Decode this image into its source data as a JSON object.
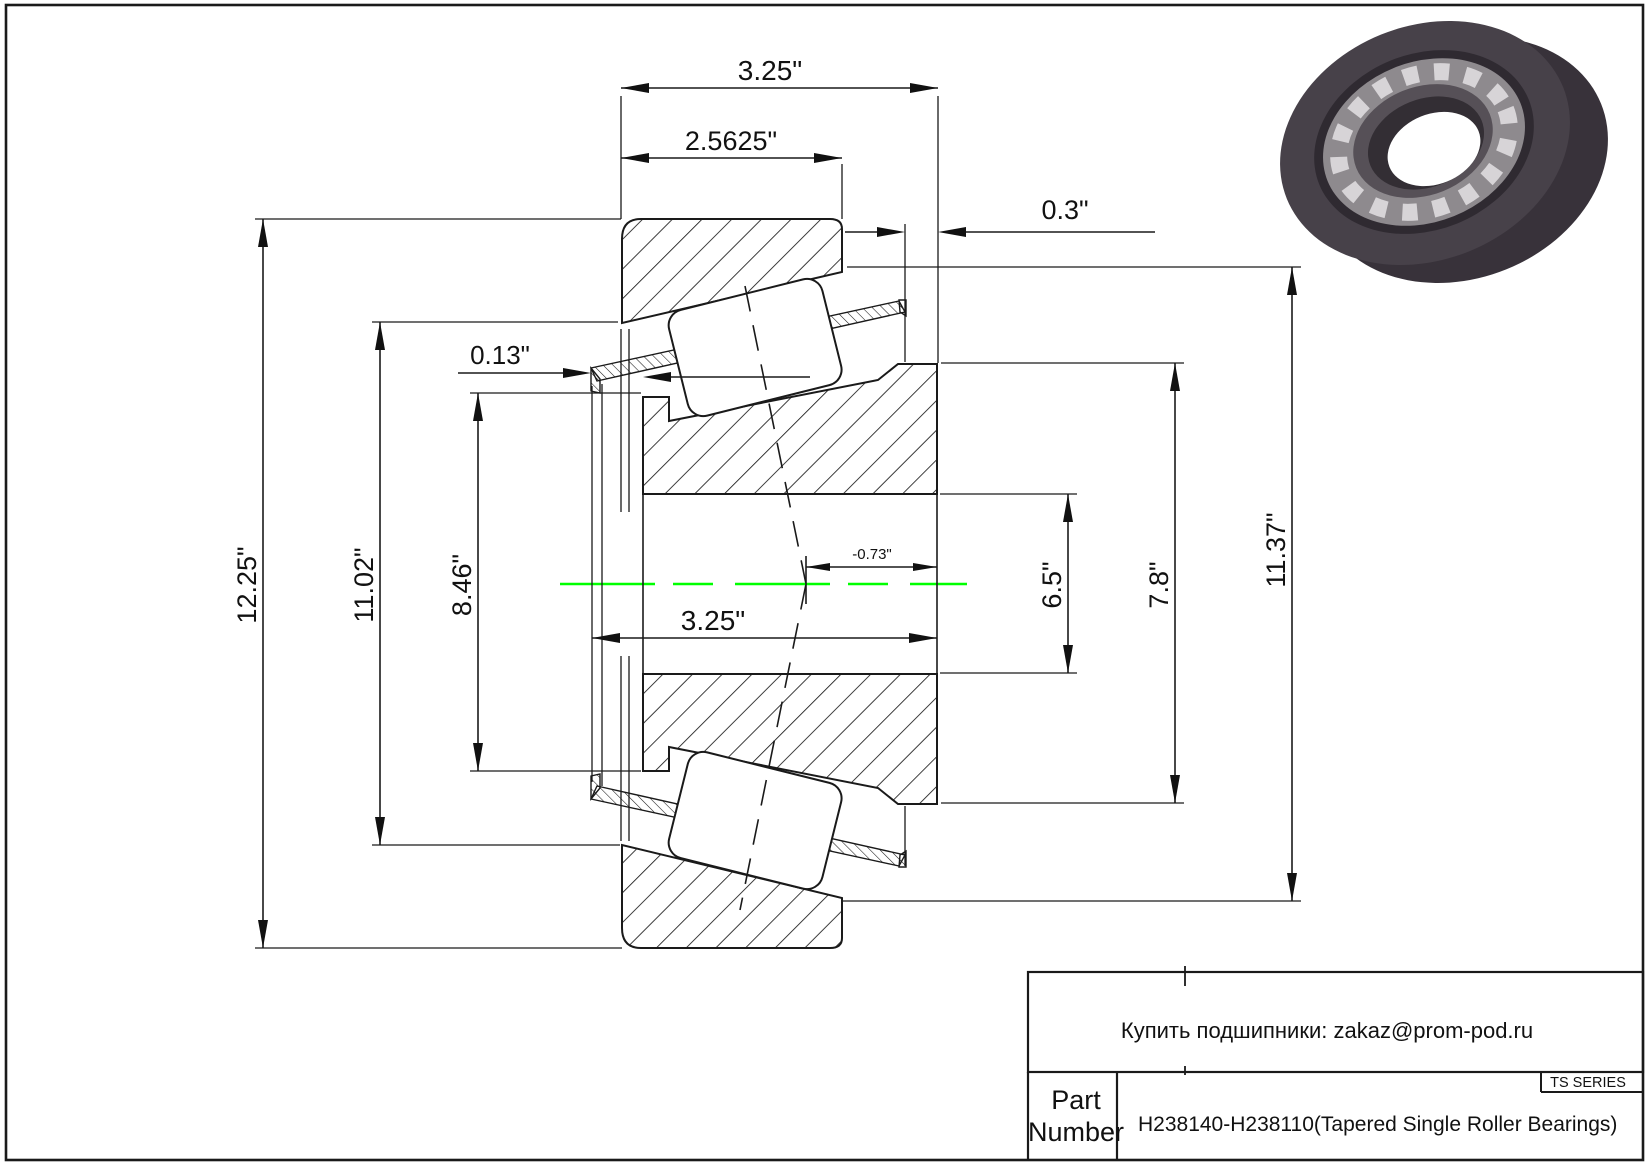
{
  "drawing": {
    "dims": {
      "overall_top": "3.25\"",
      "cup_width": "2.5625\"",
      "standout": "0.3\"",
      "cage_lip": "0.13\"",
      "outer_dia": "12.25\"",
      "dia_11_02": "11.02\"",
      "dia_8_46": "8.46\"",
      "inner_width": "3.25\"",
      "eff_center": "-0.73\"",
      "bore_dia": "6.5\"",
      "rib_dia": "7.8\"",
      "race_dia": "11.37\""
    },
    "colors": {
      "centerline": "#00FF00",
      "line": "#1a1a1a"
    }
  },
  "title_block": {
    "contact_line": "Купить подшипники: zakaz@prom-pod.ru",
    "series_label": "TS SERIES",
    "part_label_line1": "Part",
    "part_label_line2": "Number",
    "part_number": "H238140-H238110(Tapered Single Roller Bearings)"
  }
}
